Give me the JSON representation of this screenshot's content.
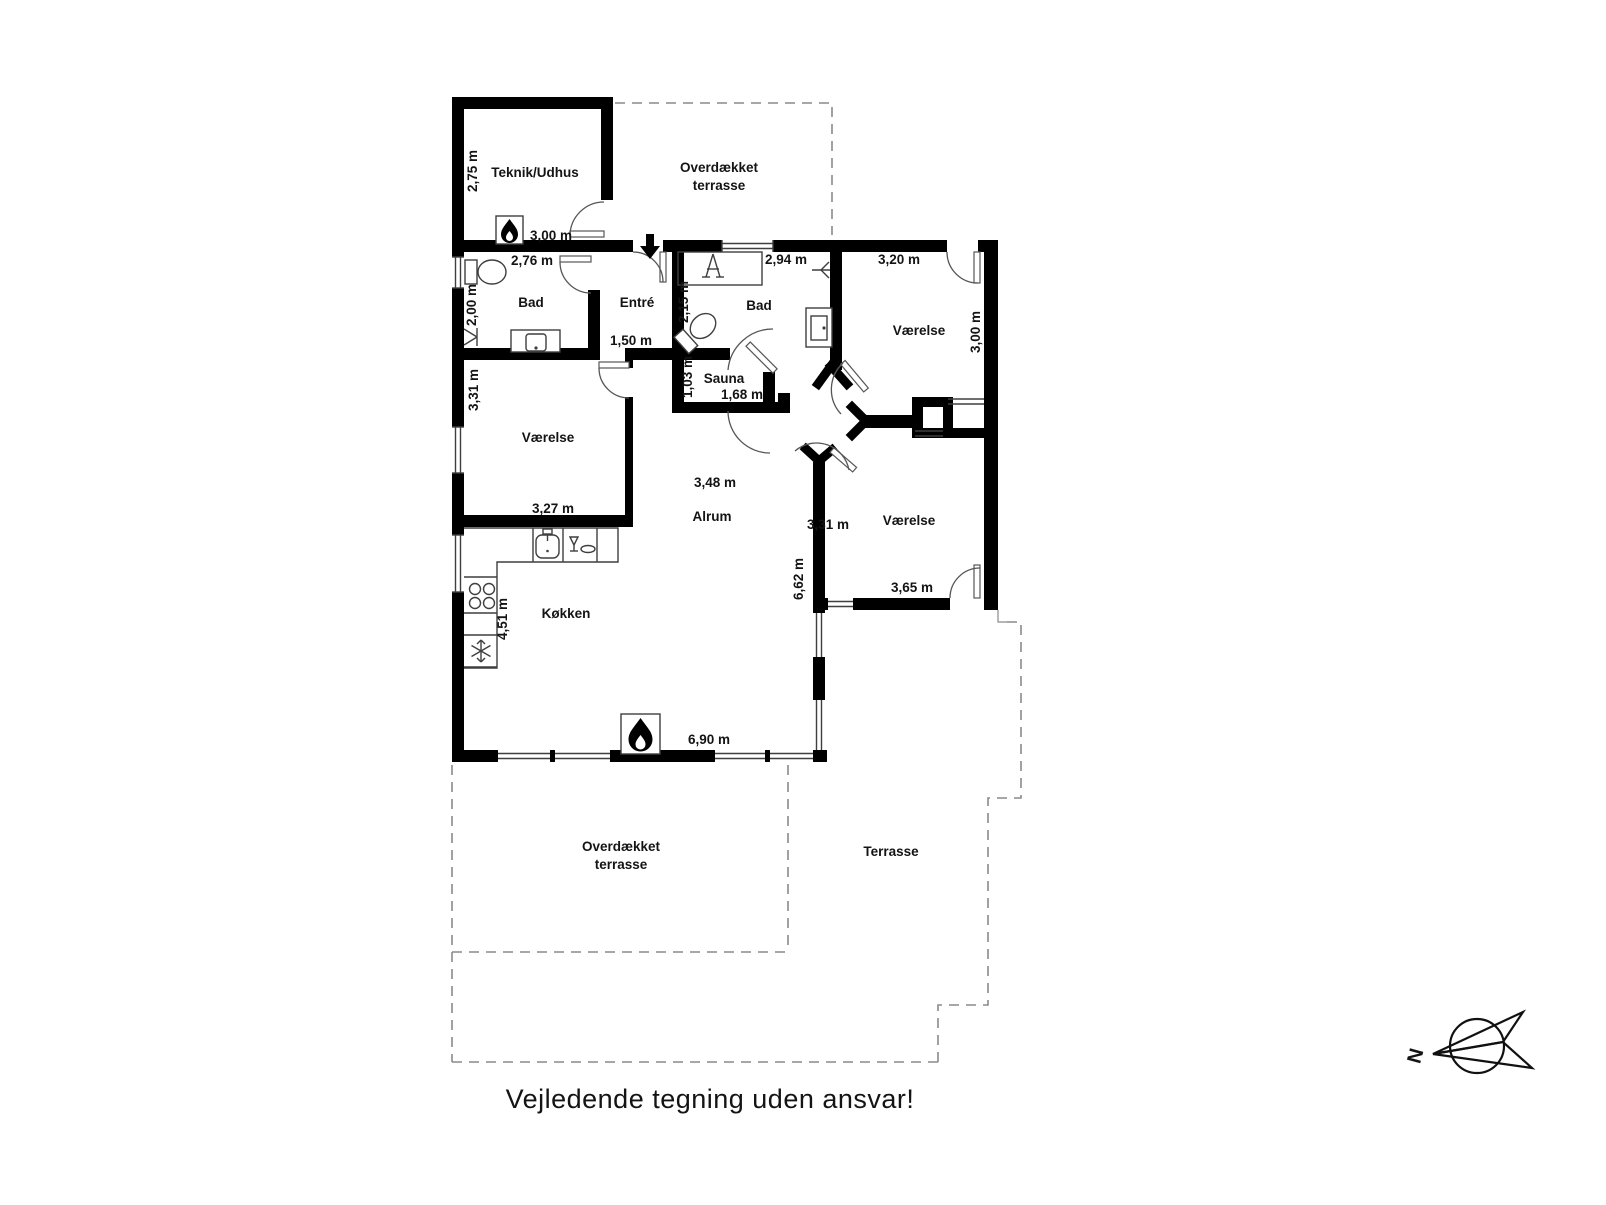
{
  "title": "Vejledende tegning uden ansvar!",
  "compass": {
    "north_label": "N"
  },
  "rooms": {
    "teknik": {
      "name": "Teknik/Udhus",
      "width": "3,00 m",
      "height": "2,75 m"
    },
    "terrace_top": {
      "line1": "Overdækket",
      "line2": "terrasse"
    },
    "bad_left": {
      "name": "Bad",
      "width": "2,76 m",
      "height": "2,00 m"
    },
    "entre": {
      "name": "Entré",
      "width": "1,50 m"
    },
    "bad_right": {
      "name": "Bad",
      "width": "2,94 m",
      "height": "2,15 m"
    },
    "vaerelse_top_right": {
      "name": "Værelse",
      "width": "3,20 m",
      "height": "3,00 m"
    },
    "sauna": {
      "name": "Sauna",
      "width": "1,68 m",
      "height": "1,03 m"
    },
    "vaerelse_left": {
      "name": "Værelse",
      "width": "3,27 m",
      "height": "3,31 m"
    },
    "alrum": {
      "name": "Alrum",
      "center_width": "3,48 m",
      "south_width": "6,90 m",
      "east_height": "6,62 m"
    },
    "vaerelse_bottom_right": {
      "name": "Værelse",
      "width": "3,65 m",
      "height": "3,31 m"
    },
    "koekken": {
      "name": "Køkken",
      "height": "4,51 m"
    },
    "terrace_bottom": {
      "line1": "Overdækket",
      "line2": "terrasse"
    },
    "terrasse": {
      "name": "Terrasse"
    }
  }
}
